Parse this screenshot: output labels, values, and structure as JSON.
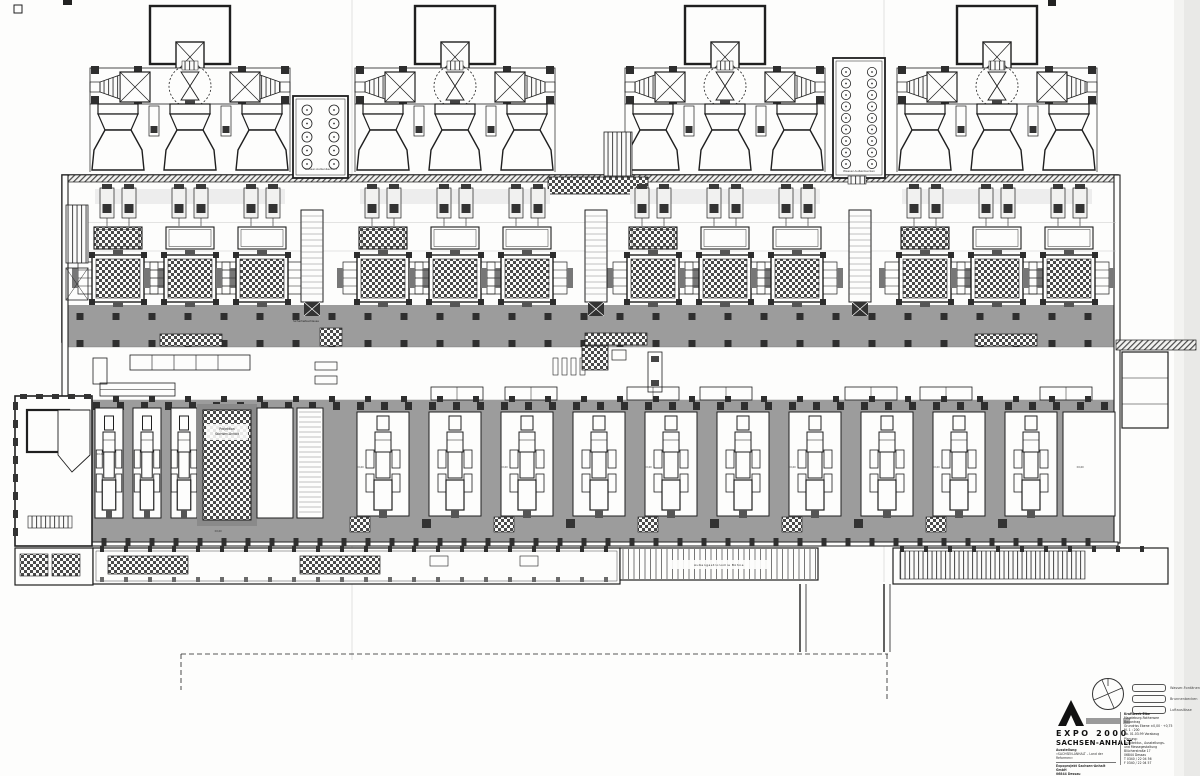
{
  "document": {
    "kind": "scanned architectural floor plan",
    "subject": "EXPO 2000 Sachsen-Anhalt pavilion — converted power station, ground floor plan"
  },
  "labels": {
    "water_basin": "Wasser-Außenbecken",
    "projection1": "Projektion",
    "projection2": "Sachsen-Anhalt",
    "security": "Sicherheitsschleuse",
    "stage": "Außengastronomie   Bühne",
    "level": "±0,00"
  },
  "title_block": {
    "brand_top": "EXPO 2000",
    "brand_bottom": "SACHSEN-ANHALT",
    "sub1": "Ausstellung",
    "sub2": "«SACHSEN-ANHALT – Land der Reformen»",
    "addr1": "Expoprojekt Sachsen-Anhalt GmbH",
    "addr2": "06844 Dessau",
    "phone": "T 0340 / 65 12-0  F 65 12-22",
    "legend": [
      {
        "label": "Wasser-Fontänen"
      },
      {
        "label": "Brunnenbecken"
      },
      {
        "label": "Luftauslässe"
      }
    ],
    "project_lines": [
      "Kraftwerk Elbe",
      "Magdeburg-Rothensee",
      "Bauantrag",
      "Grundriss Ebene ±0,00 · +0,75",
      "M. 1 : 200",
      "ab. 01.03.99 Vorabzug",
      "Planung:",
      "Architektur-, Ausstellungs-",
      "und Messegestaltung",
      "Blücherstraße 17",
      "06844 Dessau",
      "T 0340 / 22 04 56",
      "F 0340 / 22 04 57"
    ]
  },
  "colors": {
    "ink": "#1f1f1f",
    "floor_gray": "#9c9c9c",
    "pale": "#ededed",
    "scan_edge": "#e9e9e7"
  }
}
